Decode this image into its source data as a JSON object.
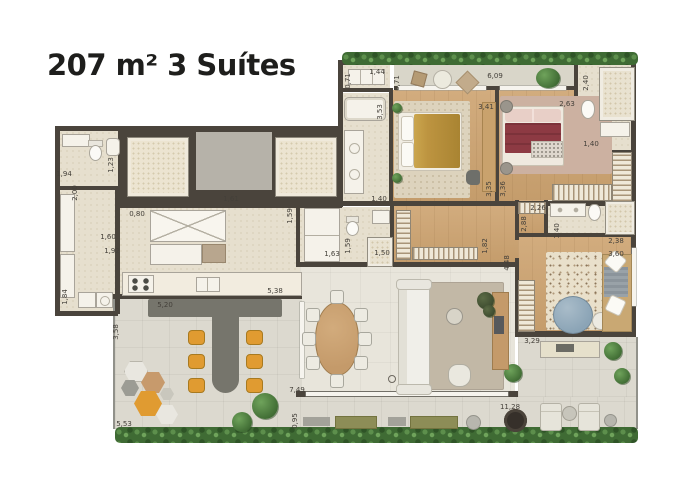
{
  "title": "207 m² 3 Suítes",
  "colors": {
    "wall": "#4a443c",
    "floor_cream": "#e6dfce",
    "floor_tile": "#dcd9cf",
    "floor_balcony": "#d9d6c9",
    "rug_living": "#c2b8a6",
    "bed_mustard": "#bd9440",
    "bed_maroon": "#8d3a43",
    "chair_orange": "#e09b31",
    "pouf_blue": "#8ba4b6",
    "plant_green": "#4f7c3e",
    "counter_gray": "#76756c",
    "label_text": "#44403a",
    "title_text": "#1e1e1c"
  },
  "dimensions": [
    {
      "t": "1,94",
      "x": 64,
      "y": 174
    },
    {
      "t": "1,23",
      "x": 111,
      "y": 165,
      "v": 1
    },
    {
      "t": "2,00",
      "x": 75,
      "y": 193,
      "v": 1
    },
    {
      "t": "0,80",
      "x": 137,
      "y": 214
    },
    {
      "t": "1,60",
      "x": 108,
      "y": 237
    },
    {
      "t": "1,92",
      "x": 112,
      "y": 251
    },
    {
      "t": "1,84",
      "x": 65,
      "y": 297,
      "v": 1
    },
    {
      "t": "1,61",
      "x": 231,
      "y": 199
    },
    {
      "t": "5,20",
      "x": 165,
      "y": 305
    },
    {
      "t": "5,38",
      "x": 275,
      "y": 291
    },
    {
      "t": "3,58",
      "x": 116,
      "y": 332,
      "v": 1
    },
    {
      "t": "5,53",
      "x": 124,
      "y": 424
    },
    {
      "t": "7,49",
      "x": 297,
      "y": 390
    },
    {
      "t": "0,95",
      "x": 295,
      "y": 421,
      "v": 1
    },
    {
      "t": "11,28",
      "x": 510,
      "y": 407
    },
    {
      "t": "3,29",
      "x": 532,
      "y": 341
    },
    {
      "t": "4,48",
      "x": 507,
      "y": 263,
      "v": 1
    },
    {
      "t": "2,88",
      "x": 524,
      "y": 224,
      "v": 1
    },
    {
      "t": "2,26",
      "x": 538,
      "y": 208
    },
    {
      "t": "2,38",
      "x": 616,
      "y": 241
    },
    {
      "t": "3,60",
      "x": 616,
      "y": 254
    },
    {
      "t": "1,40",
      "x": 557,
      "y": 231,
      "v": 1
    },
    {
      "t": "1,40",
      "x": 591,
      "y": 144
    },
    {
      "t": "2,40",
      "x": 586,
      "y": 83,
      "v": 1
    },
    {
      "t": "2,63",
      "x": 567,
      "y": 104
    },
    {
      "t": "3,41",
      "x": 486,
      "y": 107
    },
    {
      "t": "3,53",
      "x": 380,
      "y": 112,
      "v": 1
    },
    {
      "t": "0,71",
      "x": 348,
      "y": 81,
      "v": 1
    },
    {
      "t": "1,44",
      "x": 377,
      "y": 72
    },
    {
      "t": "0,71",
      "x": 397,
      "y": 83,
      "v": 1
    },
    {
      "t": "6,09",
      "x": 495,
      "y": 76
    },
    {
      "t": "3,35",
      "x": 489,
      "y": 189,
      "v": 1
    },
    {
      "t": "3,36",
      "x": 503,
      "y": 189,
      "v": 1
    },
    {
      "t": "1,40",
      "x": 379,
      "y": 199
    },
    {
      "t": "1,63",
      "x": 332,
      "y": 254
    },
    {
      "t": "1,59",
      "x": 348,
      "y": 246,
      "v": 1
    },
    {
      "t": "1,50",
      "x": 382,
      "y": 253
    },
    {
      "t": "1,82",
      "x": 485,
      "y": 246,
      "v": 1
    },
    {
      "t": "1,59",
      "x": 290,
      "y": 216,
      "v": 1
    }
  ]
}
